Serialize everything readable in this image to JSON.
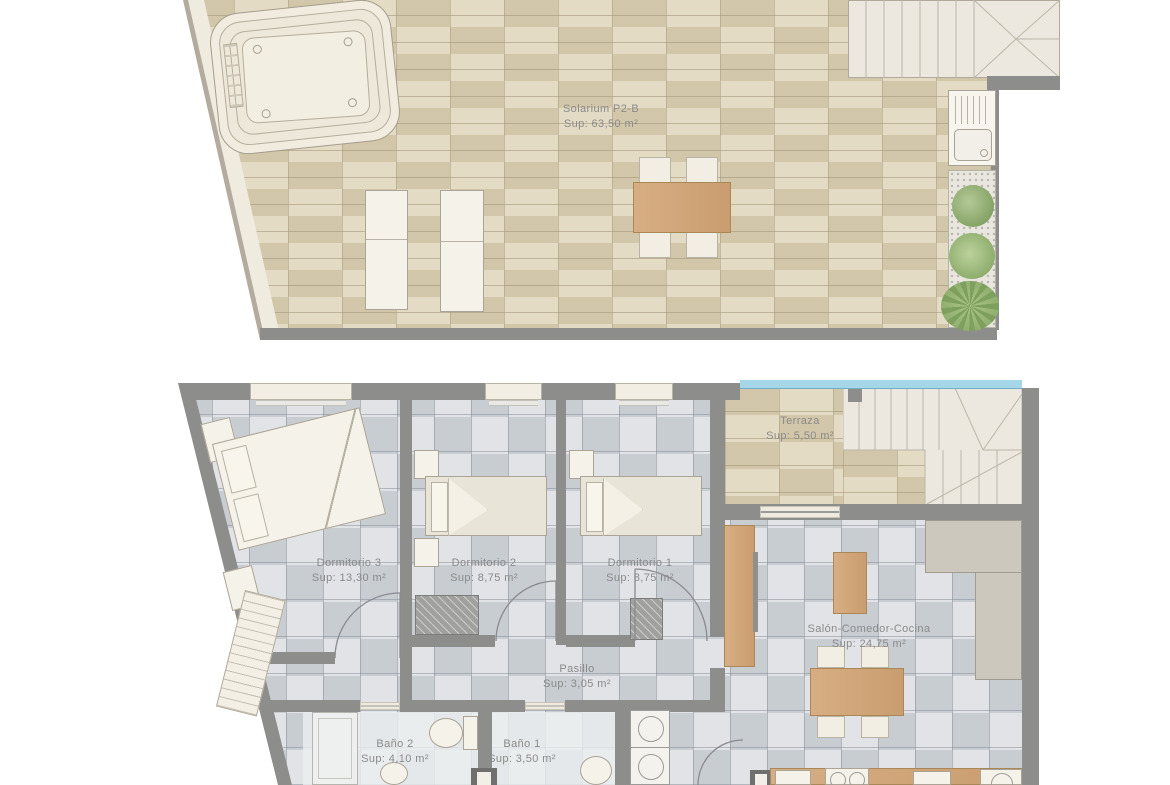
{
  "rooms": {
    "solarium": {
      "name": "Solarium P2-B",
      "area": "Sup: 63,50 m²"
    },
    "terraza": {
      "name": "Terraza",
      "area": "Sup: 5,50 m²"
    },
    "dormitorio3": {
      "name": "Dormitorio 3",
      "area": "Sup: 13,30 m²"
    },
    "dormitorio2": {
      "name": "Dormitorio 2",
      "area": "Sup: 8,75 m²"
    },
    "dormitorio1": {
      "name": "Dormitorio 1",
      "area": "Sup: 8,75 m²"
    },
    "salon": {
      "name": "Salón-Comedor-Cocina",
      "area": "Sup: 24,75 m²"
    },
    "pasillo": {
      "name": "Pasillo",
      "area": "Sup: 3,05 m²"
    },
    "bano2": {
      "name": "Baño 2",
      "area": "Sup: 4,10 m²"
    },
    "bano1": {
      "name": "Baño 1",
      "area": "Sup: 3,50 m²"
    }
  },
  "colors": {
    "wall": "#8d8d8b",
    "tile_beige": "#ddd2b6",
    "tile_gray": "#d4d7db",
    "wood": "#d0a87c",
    "water": "#a6d7e8",
    "label_text": "#8a8a8a",
    "plant_green": "#87a468"
  }
}
